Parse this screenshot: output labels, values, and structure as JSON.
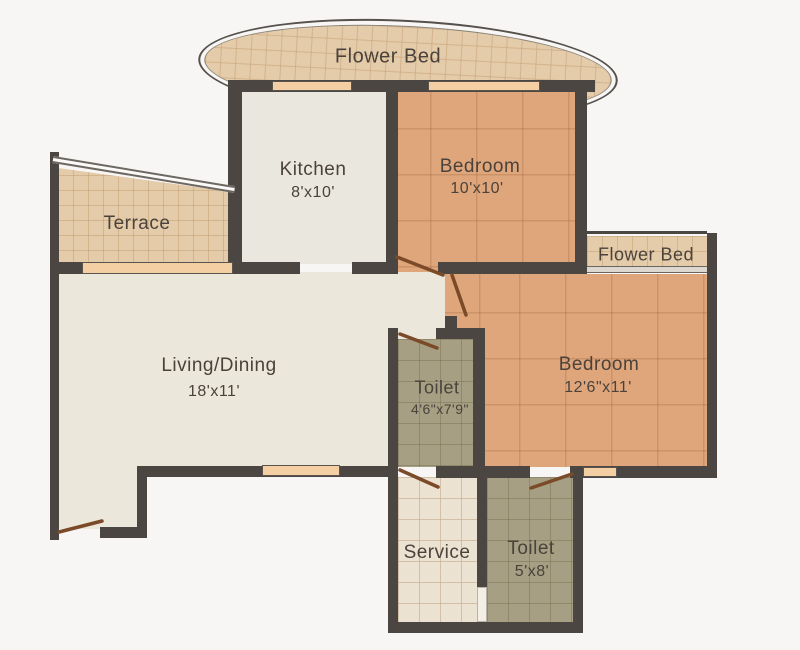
{
  "title": "Apartment Floor Plan",
  "rooms": {
    "flower_bed_top": {
      "label": "Flower Bed"
    },
    "kitchen": {
      "label": "Kitchen",
      "dims": "8'x10'"
    },
    "bedroom_top": {
      "label": "Bedroom",
      "dims": "10'x10'"
    },
    "terrace": {
      "label": "Terrace"
    },
    "flower_bed_right": {
      "label": "Flower Bed"
    },
    "living": {
      "label": "Living/Dining",
      "dims": "18'x11'"
    },
    "toilet_mid": {
      "label": "Toilet",
      "dims": "4'6\"x7'9\""
    },
    "bedroom_right": {
      "label": "Bedroom",
      "dims": "12'6\"x11'"
    },
    "service": {
      "label": "Service"
    },
    "toilet_bottom": {
      "label": "Toilet",
      "dims": "5'x8'"
    }
  },
  "colors": {
    "wall": "#4c4643",
    "bedroom_floor": "#dfa67c",
    "toilet_floor": "#a69f83",
    "service_floor": "#ece2d2",
    "terrace_floor": "#e4cba9",
    "flower_bed_floor": "#e4cba9",
    "kitchen_floor": "#eae7df",
    "living_floor": "#ebe7da",
    "window": "#f5cfa4",
    "door_leaf": "#7b4a28",
    "text": "#4a423b"
  }
}
